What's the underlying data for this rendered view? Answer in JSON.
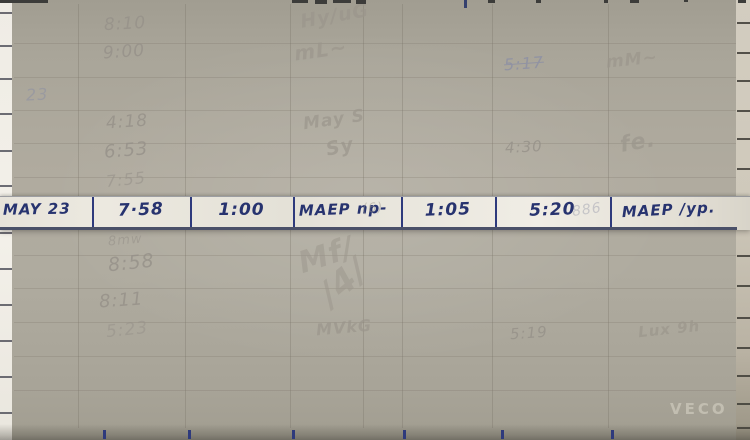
{
  "active_row": {
    "cells": [
      "MAY 23",
      "7·58",
      "1:00",
      "MAEP np-",
      "1:05",
      "5:20",
      "MAEP /yp."
    ]
  },
  "ghosts": [
    "8:10",
    "9:00",
    "Hy/uG",
    "mL~",
    "5:17",
    "mM~",
    "A",
    "23",
    "4:18",
    "6:53",
    "7:55",
    "May S",
    "Sy",
    "4:30",
    "fe.",
    "8mw",
    "8:58",
    "8:11",
    "5:23",
    "Mf/",
    "/4/",
    "MVkG",
    "5:19",
    "Lux 9h",
    "(6)",
    "886"
  ],
  "watermark": "VECO",
  "colors": {
    "ink_blue": "#27336f",
    "overlay_gray": "#aeaa9e",
    "strip_paper": "#eae7de"
  }
}
